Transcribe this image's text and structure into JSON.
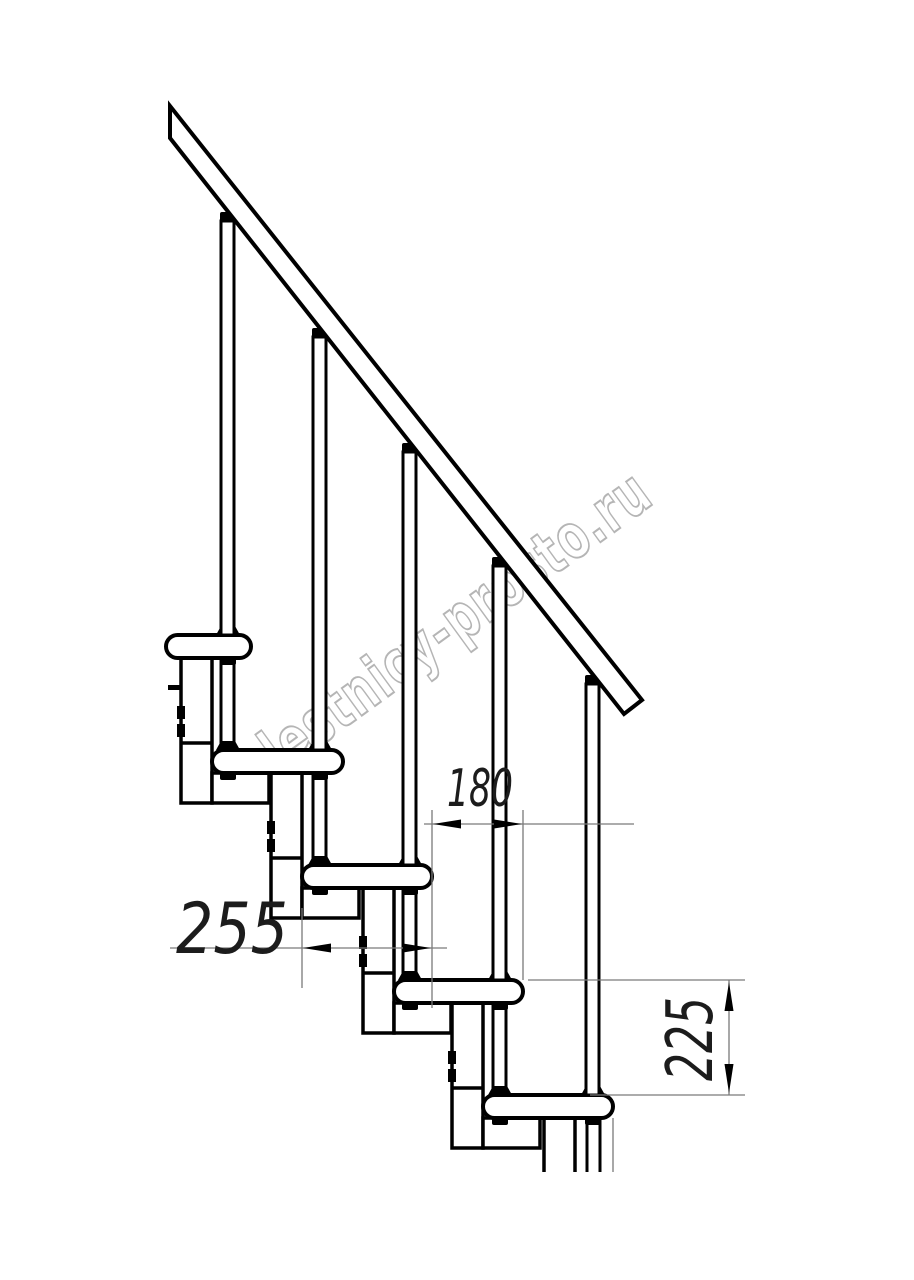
{
  "watermark": {
    "text": "lestnicy-prosto.ru",
    "color": "#b5b5b5"
  },
  "dimensions": {
    "tread_depth": {
      "value": "255"
    },
    "going": {
      "value": "180"
    },
    "rise": {
      "value": "225"
    }
  },
  "drawing": {
    "line_color": "#000000",
    "dim_line_color": "#7a7a7a",
    "background": "#ffffff",
    "tread_count": 5,
    "baluster_count": 5
  }
}
